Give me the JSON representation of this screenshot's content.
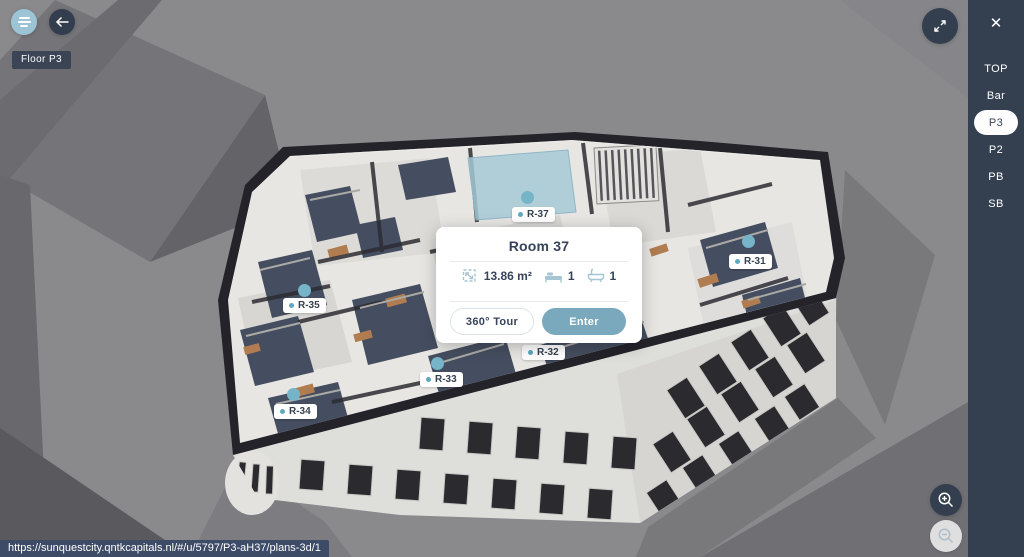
{
  "app": {
    "floor_badge": "Floor P3",
    "url": "https://sunquestcity.qntkcapitals.nl/#/u/5797/P3-aH37/plans-3d/1"
  },
  "sidebar": {
    "close_label": "✕",
    "items": [
      {
        "label": "TOP",
        "active": false
      },
      {
        "label": "Bar",
        "active": false
      },
      {
        "label": "P3",
        "active": true
      },
      {
        "label": "P2",
        "active": false
      },
      {
        "label": "PB",
        "active": false
      },
      {
        "label": "SB",
        "active": false
      }
    ]
  },
  "room_card": {
    "title": "Room 37",
    "stats": [
      {
        "icon": "area-icon",
        "value": "13.86 m²"
      },
      {
        "icon": "bed-icon",
        "value": "1"
      },
      {
        "icon": "bath-icon",
        "value": "1"
      }
    ],
    "tour_label": "360° Tour",
    "enter_label": "Enter"
  },
  "markers": [
    {
      "label": "R-37"
    },
    {
      "label": "R-31"
    },
    {
      "label": "R-35"
    },
    {
      "label": "R-32"
    },
    {
      "label": "R-33"
    },
    {
      "label": "R-34"
    }
  ],
  "colors": {
    "accent": "#7aa8bc",
    "sidebar_bg": "#343f50",
    "marker": "#76b4c9",
    "menu_button_bg": "#9cc4d5",
    "highlight_room": "#a6c9d6",
    "badge_bg": "#364152",
    "url_bar_bg": "#3d4b66"
  }
}
